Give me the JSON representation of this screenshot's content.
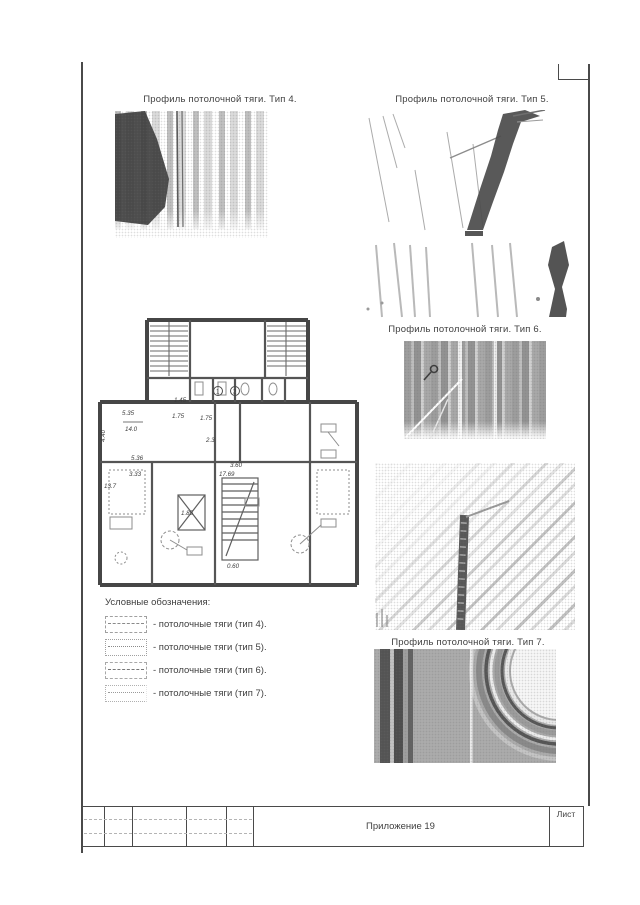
{
  "figures": {
    "type4": {
      "title": "Профиль потолочной тяги. Тип 4."
    },
    "type5": {
      "title": "Профиль потолочной тяги. Тип 5."
    },
    "type6": {
      "title": "Профиль потолочной тяги. Тип 6."
    },
    "type7": {
      "title": "Профиль потолочной тяги. Тип 7."
    }
  },
  "legend": {
    "title": "Условные обозначения:",
    "items": [
      {
        "label": "- потолочные тяги (тип 4)."
      },
      {
        "label": "- потолочные тяги (тип 5)."
      },
      {
        "label": "- потолочные тяги (тип 6)."
      },
      {
        "label": "- потолочные тяги (тип 7)."
      }
    ]
  },
  "plan": {
    "dims": [
      "5.35",
      "14.0",
      "5.36",
      "3.33",
      "13.7",
      "1.75",
      "1.75",
      "1.45",
      "3.60",
      "17.69",
      "2.3",
      "0.60",
      "1.85",
      "4.40"
    ],
    "rooms": {
      "r1": "1",
      "r2": "2"
    }
  },
  "title_block": {
    "appendix": "Приложение 19",
    "sheet": "Лист"
  }
}
